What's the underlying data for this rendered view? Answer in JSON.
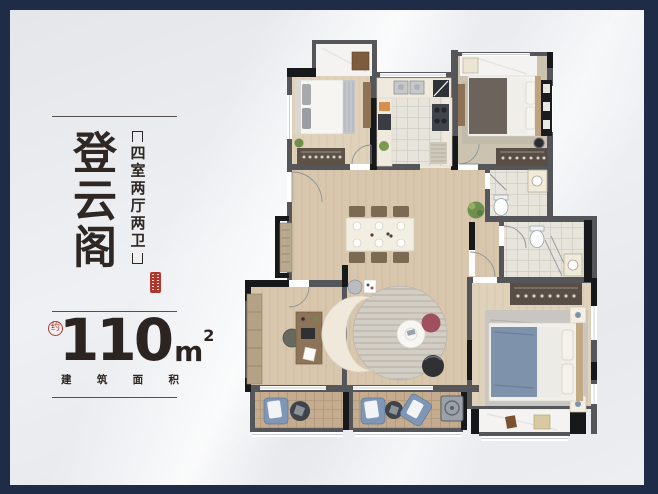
{
  "frame": {
    "navy": "#1e2c47",
    "canvas_bg": "#e9ebee"
  },
  "left_panel": {
    "title": "登云阁",
    "spec": "四室两厅两卫",
    "area_prefix": "约",
    "area_value": "110",
    "area_unit": "m",
    "area_exponent": "2",
    "caption_chars": [
      "建",
      "筑",
      "面",
      "积"
    ],
    "accent_red": "#b0372d",
    "text_color": "#2e2723"
  },
  "floor_plan": {
    "rooms": [
      "bay-window",
      "bedroom",
      "kitchen",
      "bedroom",
      "bathroom",
      "entry-hall",
      "dining-area",
      "corridor",
      "study",
      "living-room",
      "balcony",
      "balcony",
      "master-bathroom",
      "master-bedroom",
      "bay-window"
    ],
    "colors": {
      "wall": "#55565a",
      "wall_dark": "#17181a",
      "wood": "#d8c7ad",
      "bedroom_wood": "#e0d2ba",
      "tile": "#e7e4dc",
      "balcony_tile": "#c6ac8e",
      "marble": "#f4f3f1",
      "sofa": "#f0e9db",
      "lounge_blue": "#7e97b6",
      "pouf_red": "#9f4f5e",
      "bed_blue": "#7e93ab"
    }
  }
}
